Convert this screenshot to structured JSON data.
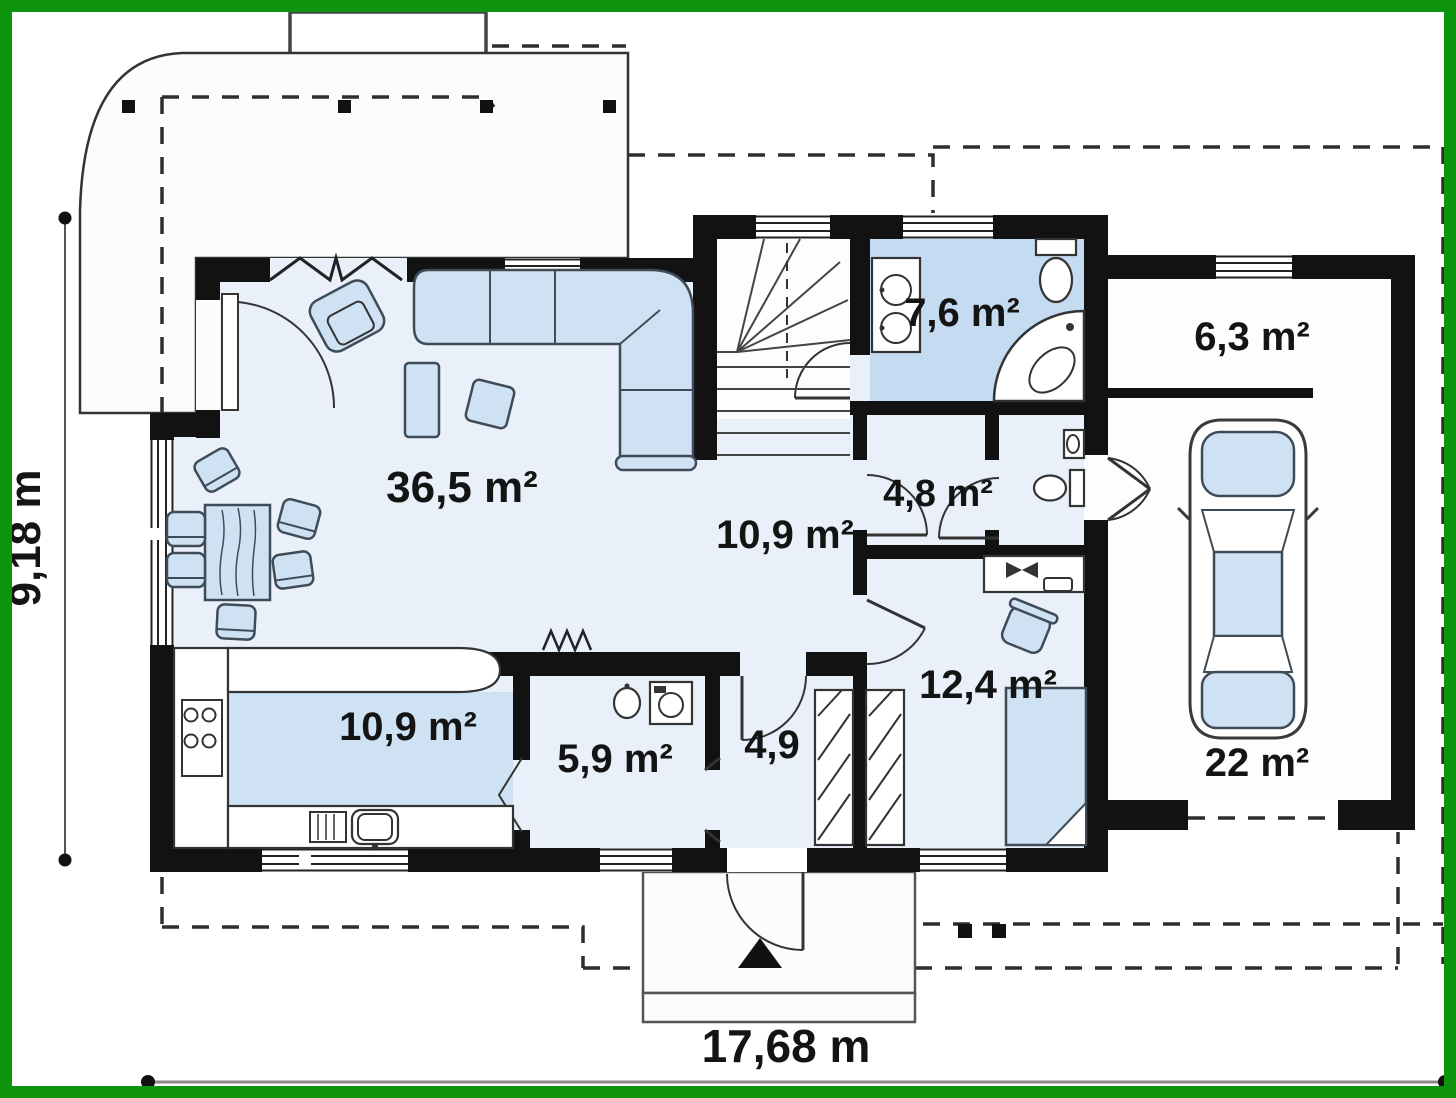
{
  "plan": {
    "rooms": [
      {
        "name": "living-room",
        "area": "36,5 m²"
      },
      {
        "name": "hall",
        "area": "10,9 m²"
      },
      {
        "name": "kitchen",
        "area": "10,9 m²"
      },
      {
        "name": "utility-room",
        "area": "5,9 m²"
      },
      {
        "name": "entrance-hall",
        "area": "4,9"
      },
      {
        "name": "bathroom",
        "area": "7,6 m²"
      },
      {
        "name": "wc",
        "area": "4,8 m²"
      },
      {
        "name": "bedroom",
        "area": "12,4 m²"
      },
      {
        "name": "storage",
        "area": "6,3 m²"
      },
      {
        "name": "garage",
        "area": "22 m²"
      }
    ],
    "dimensions": {
      "total_width": "17,68 m",
      "total_height": "9,18 m"
    },
    "colors": {
      "frame": "#0e940e",
      "wall": "#121212",
      "floor": "#e9f0f9",
      "floor_accent": "#cfe2f4",
      "bathroom_floor": "#c5dbf2",
      "furniture": "#cfe2f4",
      "furniture_outline": "#3f4c57"
    }
  }
}
